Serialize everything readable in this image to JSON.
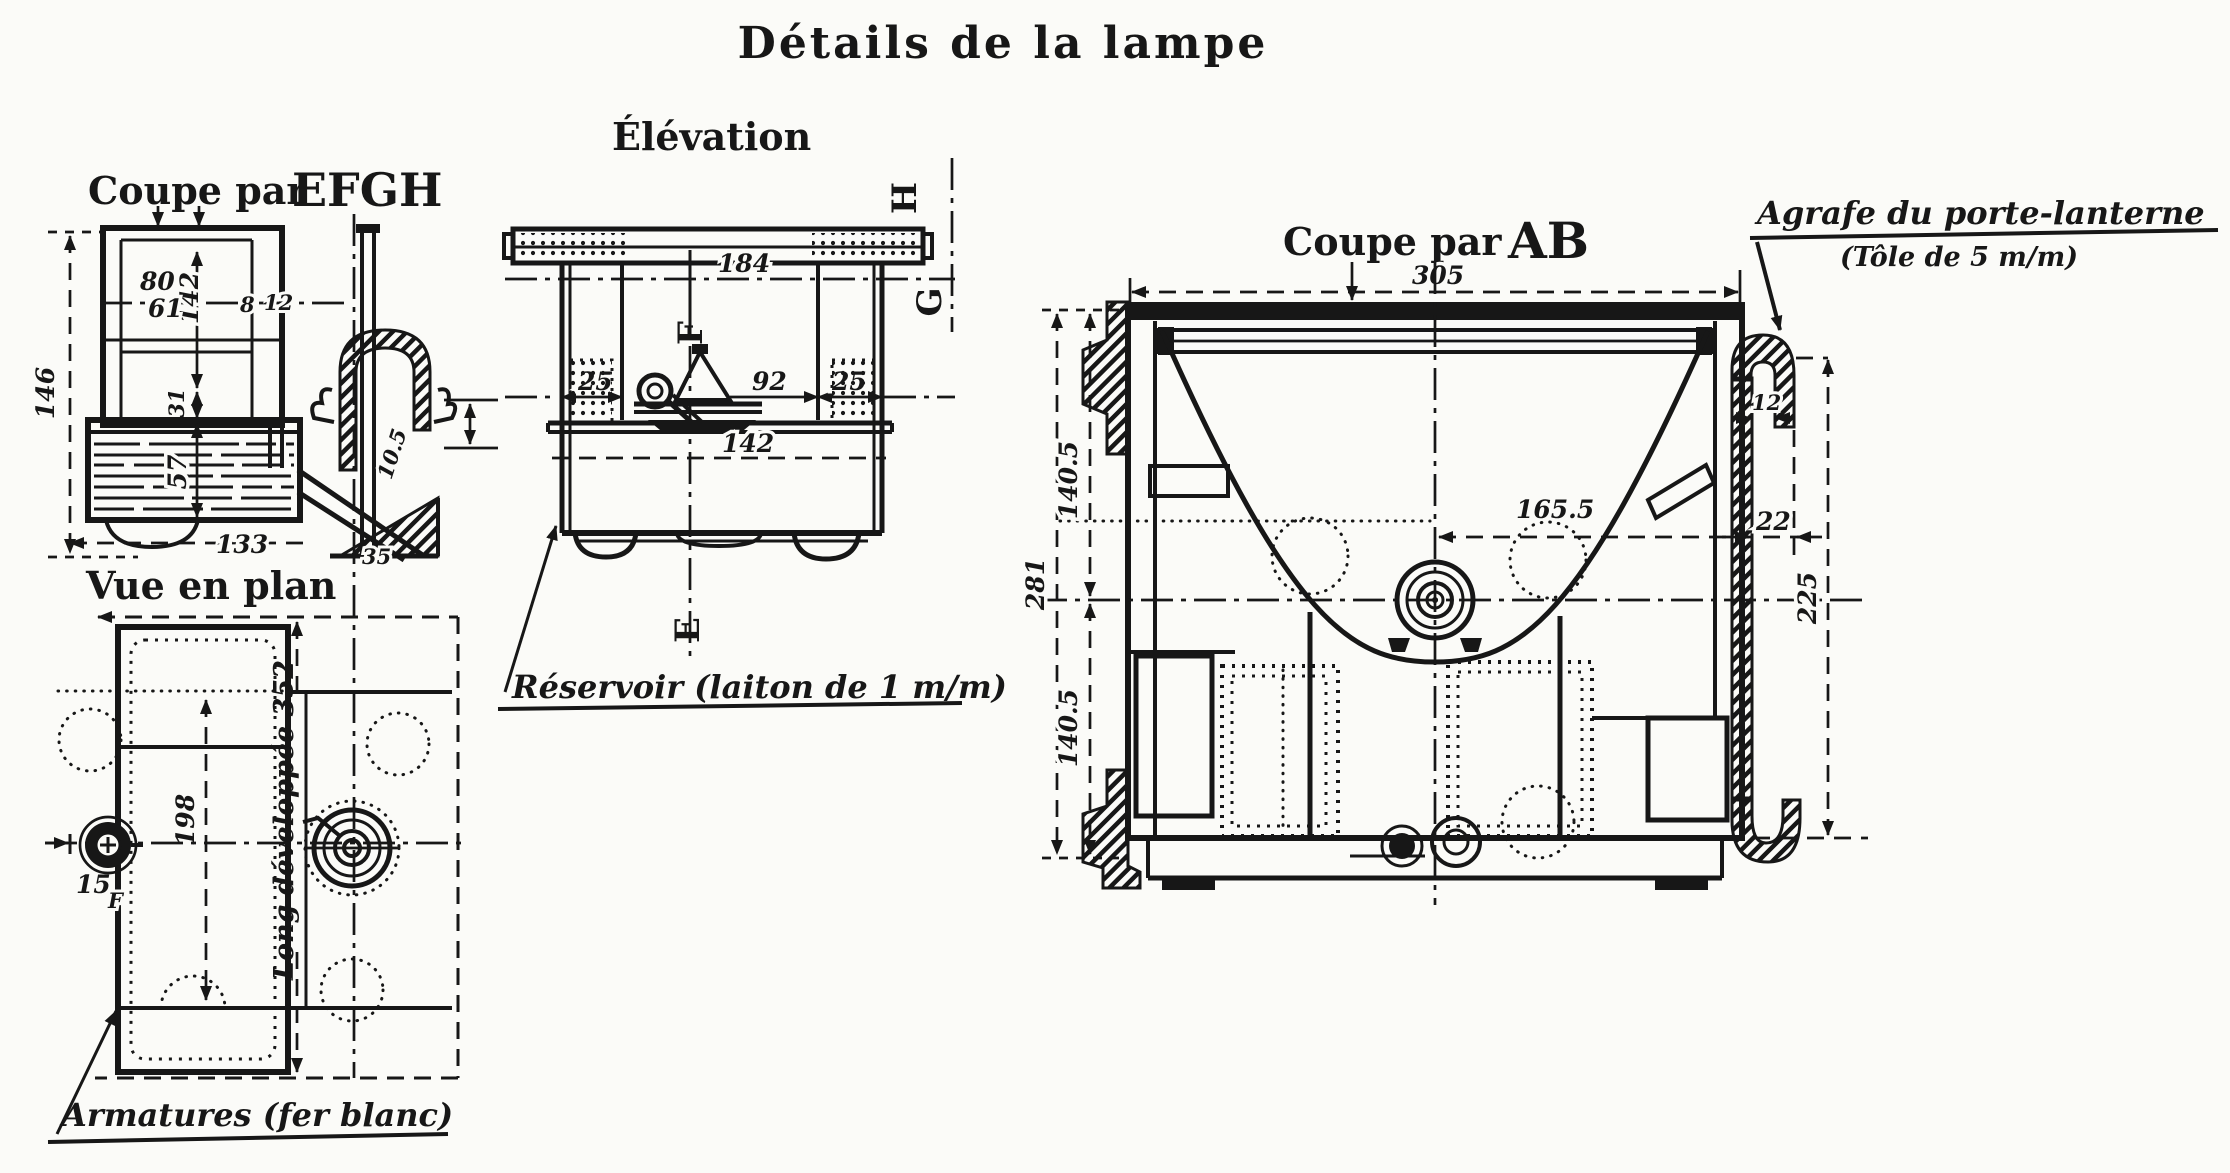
{
  "page": {
    "title": "Détails de la lampe"
  },
  "views": {
    "coupe_efgh": {
      "title_prefix": "Coupe par",
      "title_letters": "EFGH",
      "dims": {
        "total_height": "146",
        "top_width": "80",
        "inner_width": "61",
        "inner_height": "142",
        "wall_a": "8",
        "wall_b": "12",
        "collar_height": "31",
        "tank_height": "57",
        "tank_width": "133",
        "base_offset": "35",
        "clamp_thickness": "10.5"
      }
    },
    "elevation": {
      "title": "Élévation",
      "dims": {
        "top_width": "184",
        "side_left": "25",
        "center_span": "92",
        "side_right": "25",
        "tank_width": "142"
      },
      "letters": {
        "f": "F",
        "e": "E",
        "h": "H",
        "g": "G"
      }
    },
    "vue_plan": {
      "title": "Vue en plan",
      "dims": {
        "depth": "198",
        "developed_length": "Long développée 352",
        "filler_offset": "15"
      },
      "letters": {
        "f": "F"
      }
    },
    "coupe_ab": {
      "title_prefix": "Coupe par",
      "title_letters": "AB",
      "dims": {
        "top_width": "305",
        "total_height": "281",
        "upper_half": "140.5",
        "lower_half": "140.5",
        "burner_offset": "165.5",
        "hook_gap": "12",
        "hook_offset": "22",
        "hook_height": "225"
      }
    }
  },
  "annotations": {
    "agrafe_title": "Agrafe du porte-lanterne",
    "agrafe_sub": "(Tôle de 5 m/m)",
    "reservoir": "Réservoir (laiton de 1 m/m)",
    "armatures": "Armatures (fer blanc)"
  }
}
